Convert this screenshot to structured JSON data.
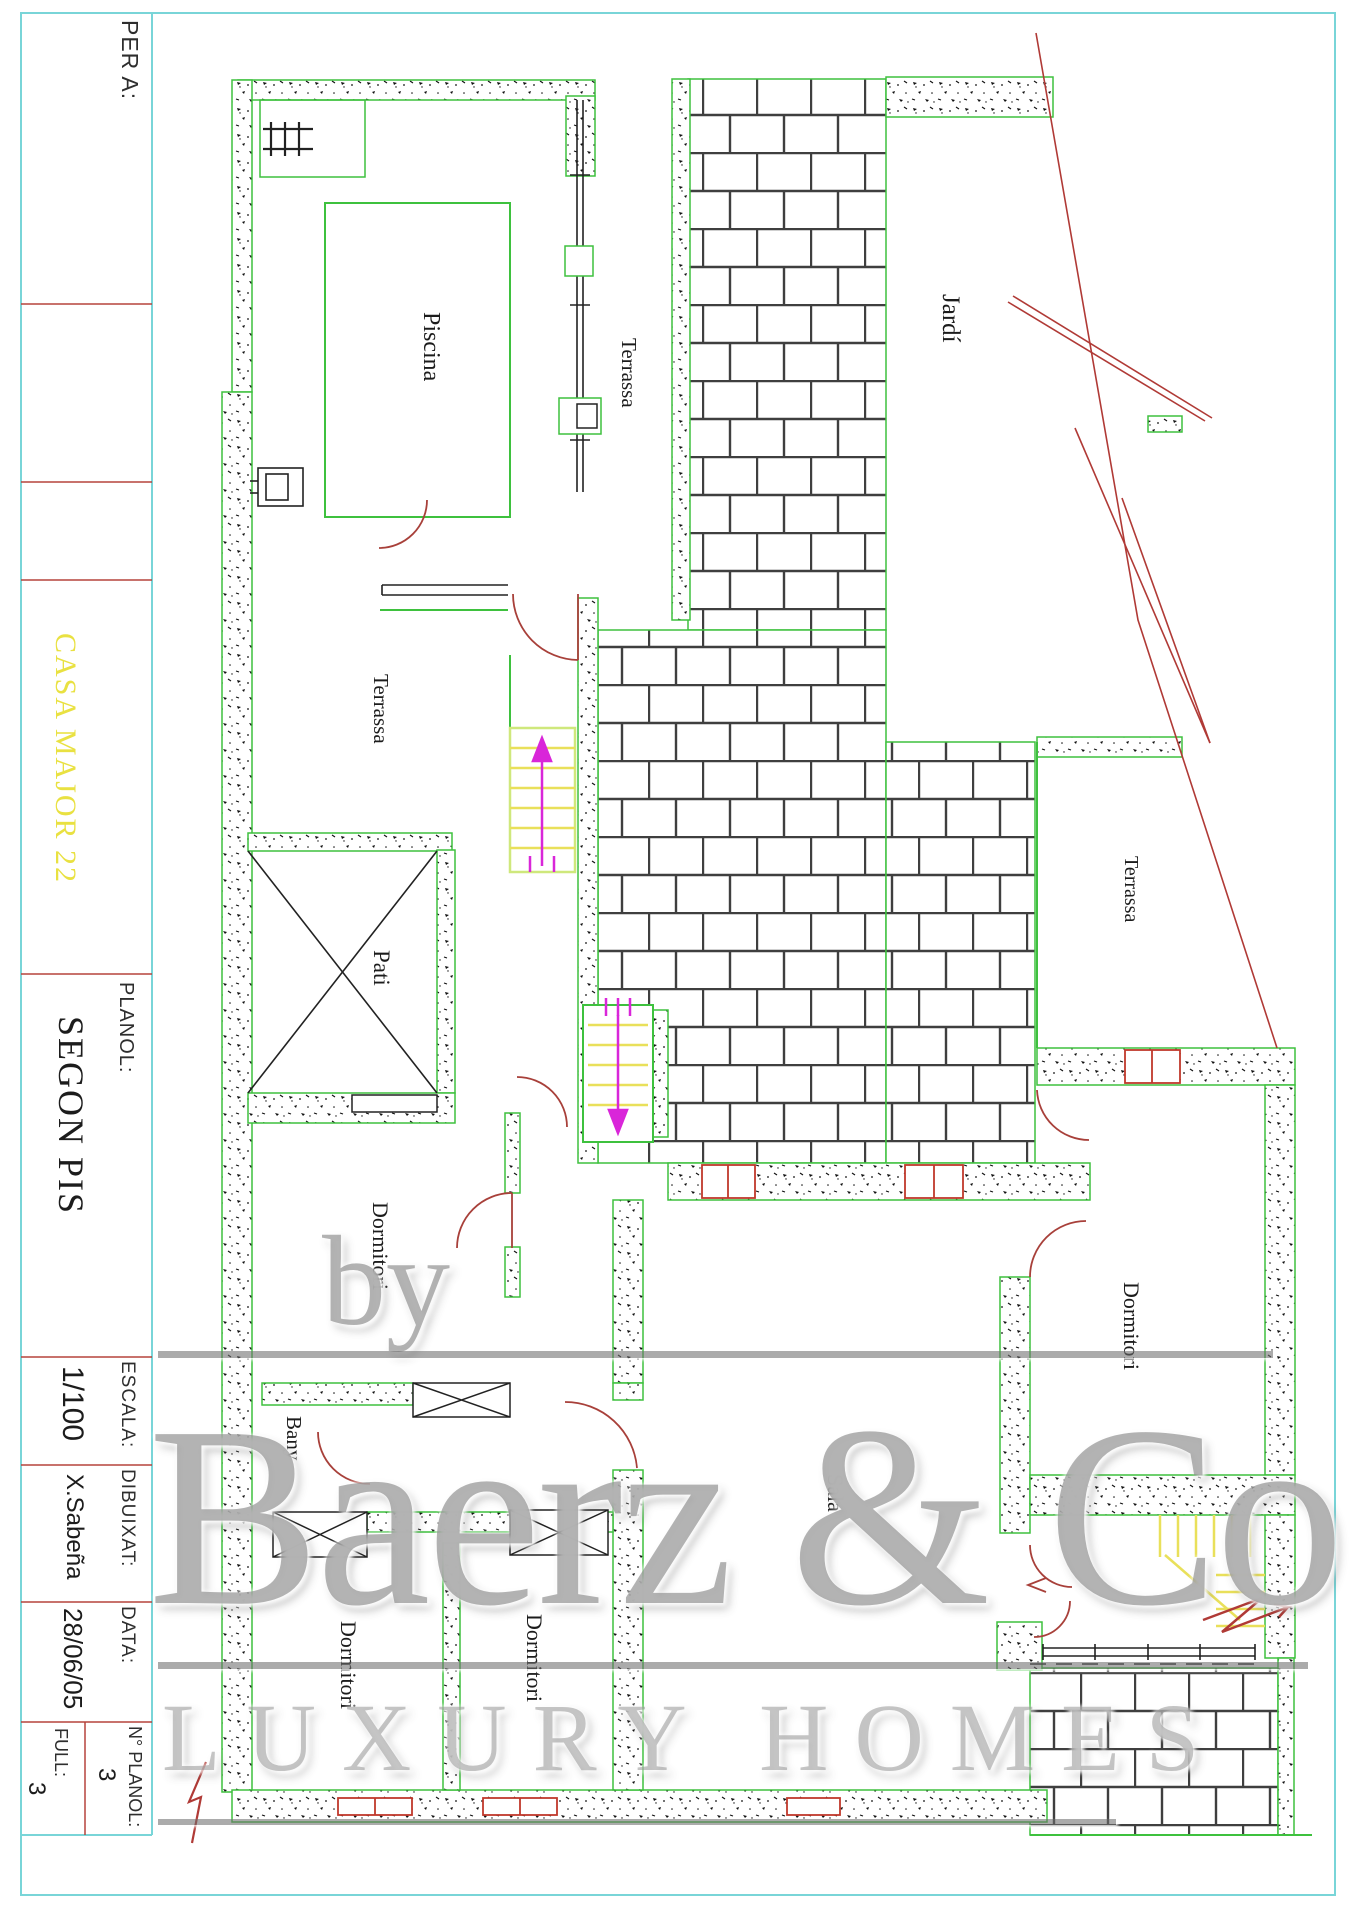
{
  "title_block": {
    "client_label": "PER A:",
    "project_name": "CASA MAJOR 22",
    "plan_label": "PLANOL:",
    "plan_name": "SEGON PIS",
    "scale_label": "ESCALA:",
    "scale_value": "1/100",
    "drawn_by_label": "DIBUIXAT:",
    "drawn_by_value": "X.Sabeña",
    "date_label": "DATA:",
    "date_value": "28/06/05",
    "plan_number_label": "N° PLANOL:",
    "plan_number_value": "3",
    "sheet_label": "FULL:",
    "sheet_value": "3"
  },
  "rooms": {
    "piscina": "Piscina",
    "terrassa_pool": "Terrassa",
    "jardi": "Jardí",
    "terrassa_mid": "Terrassa",
    "pati": "Pati",
    "terrassa_right": "Terrassa",
    "dormitori_left": "Dormitori",
    "dormitori_right": "Dormitori",
    "bany": "Bany",
    "sala": "Sala",
    "dormitori_bottom_left": "Dormitori",
    "dormitori_bottom_mid": "Dormitori"
  },
  "watermark": {
    "by": "by",
    "brand": "Baerz & Co",
    "tagline": "LUXURY HOMES"
  },
  "colors": {
    "frame_cyan": "#79d5d8",
    "wall_green": "#3ec13e",
    "divider_red": "#b5433c",
    "door_red": "#a8403a",
    "window_red": "#c0392b",
    "stair_yellow": "#e9e05a",
    "arrow_magenta": "#d926d9",
    "project_yellow": "#e9e141",
    "brick_gray": "#3f3f3f"
  }
}
